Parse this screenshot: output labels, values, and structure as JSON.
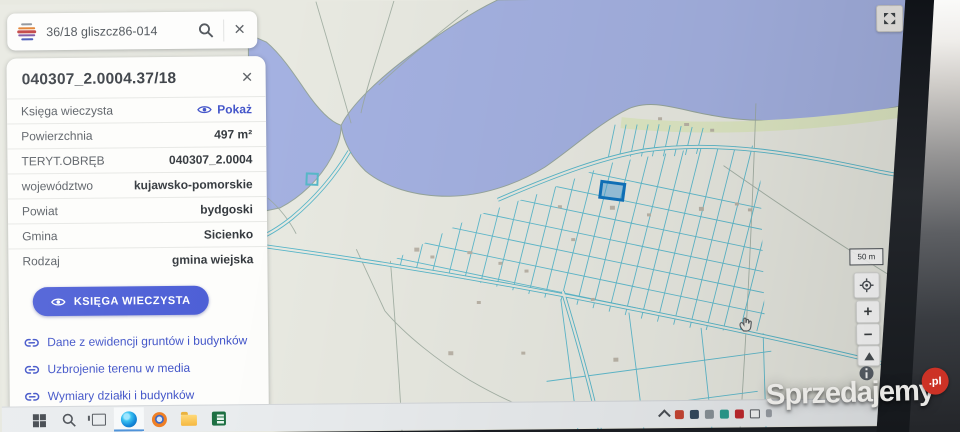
{
  "search_bar": {
    "query": "36/18 gliszcz86-014",
    "close_label": "×"
  },
  "parcel_panel": {
    "title": "040307_2.0004.37/18",
    "close_label": "×",
    "rows": [
      {
        "label": "Księga wieczysta",
        "value": "Pokaż"
      },
      {
        "label": "Powierzchnia",
        "value": "497 m²"
      },
      {
        "label": "TERYT.OBRĘB",
        "value": "040307_2.0004"
      },
      {
        "label": "województwo",
        "value": "kujawsko-pomorskie"
      },
      {
        "label": "Powiat",
        "value": "bydgoski"
      },
      {
        "label": "Gmina",
        "value": "Sicienko"
      },
      {
        "label": "Rodzaj",
        "value": "gmina wiejska"
      }
    ],
    "primary_button": "KSIĘGA WIECZYSTA",
    "links": [
      "Dane z ewidencji gruntów i budynków",
      "Uzbrojenie terenu w media",
      "Wymiary działki i budynków"
    ]
  },
  "map": {
    "scale_label": "50 m",
    "zoom_in_label": "+",
    "zoom_out_label": "−",
    "water_color": "#a4b1e1",
    "land_color": "#e8e9e1",
    "parcel_line_color": "#5fbacd",
    "selected_parcel_color": "#1073bd"
  },
  "watermark": {
    "text": "Sprzedajemy",
    "badge": ".pl",
    "badge_color": "#cc3226"
  },
  "theme": {
    "accent_blue": "#4c5ed6",
    "link_blue": "#4254c9"
  }
}
